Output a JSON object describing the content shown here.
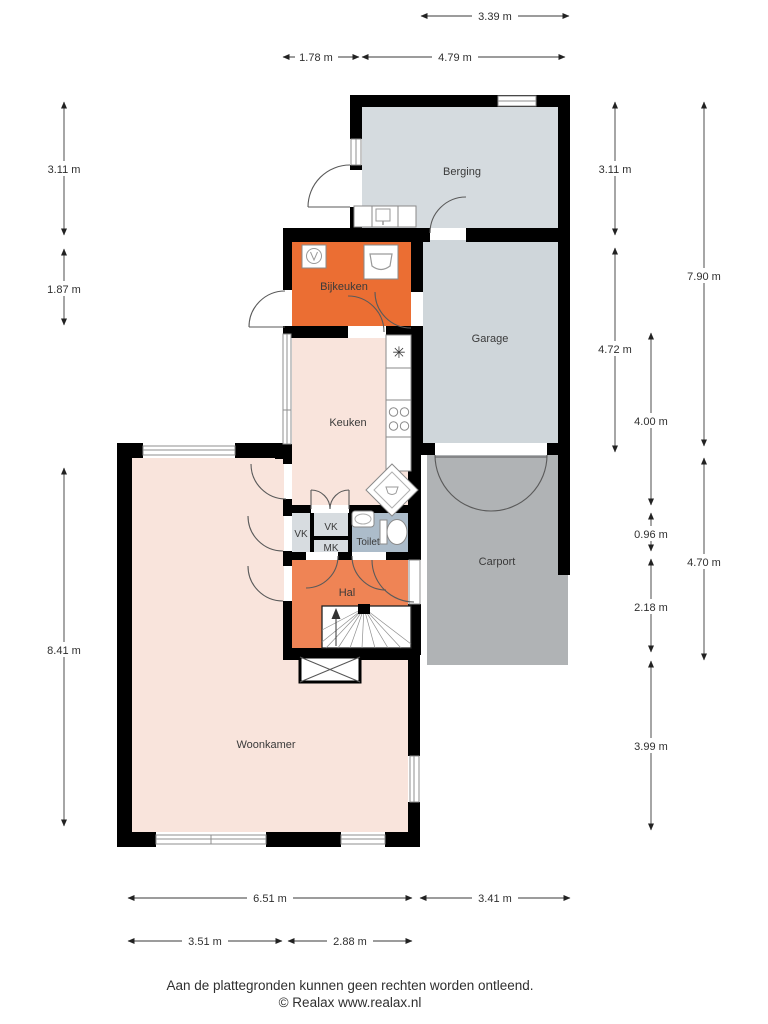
{
  "title": "Floor plan ground floor (plattegrond begane grond)",
  "colors": {
    "wall": "#000000",
    "berging": "#D5DBDF",
    "garage": "#CFD6DA",
    "bijkeuken": "#EB6E33",
    "hal": "#EF8455",
    "keuken": "#F9E4DC",
    "woonkamer": "#F9E4DC",
    "carport": "#B0B3B5",
    "toilet": "#ACBCCA",
    "vk": "#D7DCE0",
    "mk": "#D7DCE0",
    "window_glass": "#8f8f8f",
    "door_stroke": "#5a5a5a",
    "dim_line": "#3a3a3a"
  },
  "rooms": {
    "berging": {
      "label": "Berging"
    },
    "bijkeuken": {
      "label": "Bijkeuken"
    },
    "garage": {
      "label": "Garage"
    },
    "keuken": {
      "label": "Keuken"
    },
    "carport": {
      "label": "Carport"
    },
    "toilet": {
      "label": "Toilet"
    },
    "hal": {
      "label": "Hal"
    },
    "woonkamer": {
      "label": "Woonkamer"
    },
    "vk_left": {
      "label": "VK"
    },
    "vk_center": {
      "label": "VK"
    },
    "mk": {
      "label": "MK"
    }
  },
  "dims": {
    "t1": {
      "label": "3.39 m"
    },
    "t2": {
      "label": "1.78 m"
    },
    "t3": {
      "label": "4.79 m"
    },
    "l1": {
      "label": "3.11 m"
    },
    "l2": {
      "label": "1.87 m"
    },
    "l3": {
      "label": "8.41 m"
    },
    "r1": {
      "label": "3.11 m"
    },
    "r2": {
      "label": "4.72 m"
    },
    "r3": {
      "label": "4.00 m"
    },
    "r4": {
      "label": "0.96 m"
    },
    "r5": {
      "label": "2.18 m"
    },
    "r6": {
      "label": "3.99 m"
    },
    "r7": {
      "label": "7.90 m"
    },
    "r8": {
      "label": "4.70 m"
    },
    "b1": {
      "label": "6.51 m"
    },
    "b2": {
      "label": "3.41 m"
    },
    "b3": {
      "label": "3.51 m"
    },
    "b4": {
      "label": "2.88 m"
    }
  },
  "footer": {
    "line1": "Aan de plattegronden kunnen geen rechten worden ontleend.",
    "line2": "© Realax www.realax.nl"
  }
}
